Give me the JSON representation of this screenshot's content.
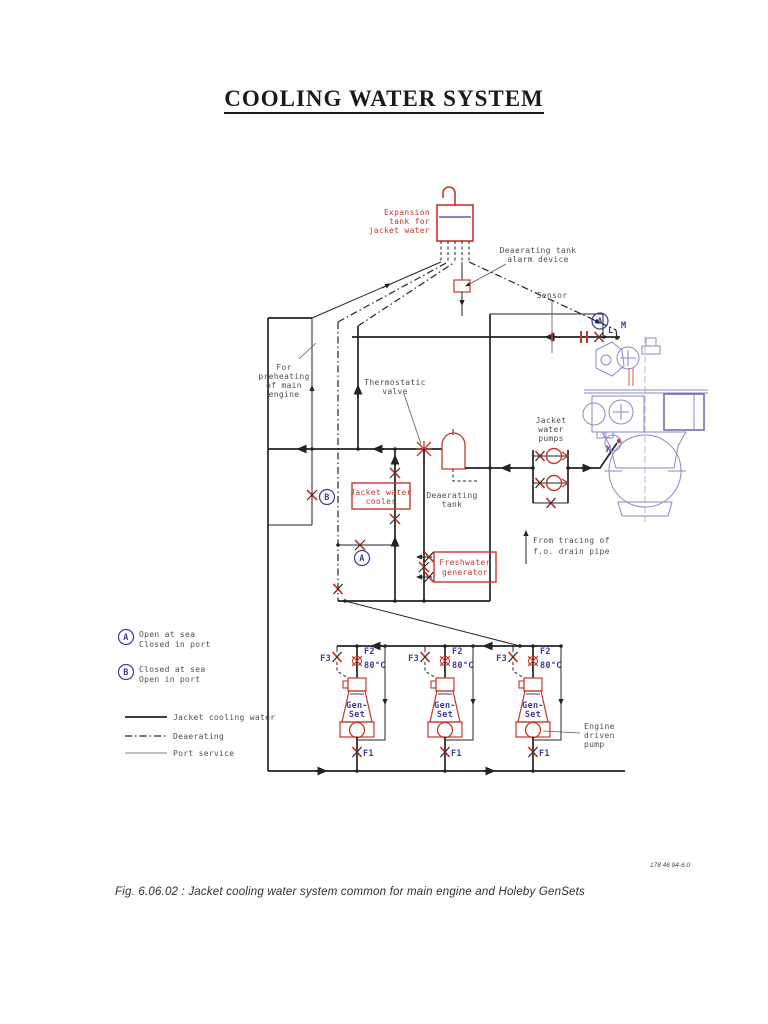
{
  "page": {
    "title": "COOLING WATER SYSTEM",
    "caption": "Fig. 6.06.02 : Jacket cooling water system common for main engine and Holeby GenSets",
    "doc_number": "178 46 94-6.0"
  },
  "colors": {
    "red": "#c4372c",
    "blue_label": "#3c3c9e",
    "engine_blue": "#8a8ac6",
    "line": "#232323"
  },
  "labels": {
    "expansion_tank": [
      "Expansion",
      "tank for",
      "jacket water"
    ],
    "deaerating_alarm": [
      "Deaerating tank",
      "alarm device"
    ],
    "sensor": "Sensor",
    "preheating": [
      "For",
      "preheating",
      "of main",
      "engine"
    ],
    "thermostatic_valve": [
      "Thermostatic",
      "valve"
    ],
    "jacket_water_cooler": [
      "Jacket water",
      "cooler"
    ],
    "deaerating_tank": [
      "Deaerating",
      "tank"
    ],
    "freshwater_generator": [
      "Freshwater",
      "generator"
    ],
    "jacket_water_pumps": [
      "Jacket",
      "water",
      "pumps"
    ],
    "fo_tracing": [
      "From tracing of",
      "f.o. drain pipe"
    ],
    "engine_driven_pump": [
      "Engine",
      "driven",
      "pump"
    ]
  },
  "connections": {
    "a": "A",
    "b": "B",
    "l": "L",
    "m": "M",
    "k": "K"
  },
  "valve_legend": {
    "a_symbol": "A",
    "a_line1": "Open at sea",
    "a_line2": "Closed in port",
    "b_symbol": "B",
    "b_line1": "Closed at sea",
    "b_line2": "Open in port"
  },
  "line_legend": [
    {
      "label": "Jacket cooling water"
    },
    {
      "label": "Deaerating"
    },
    {
      "label": "Port service"
    }
  ],
  "gensets": {
    "name_line1": "Gen-",
    "name_line2": "Set",
    "f1": "F1",
    "f2": "F2",
    "f3": "F3",
    "temp": "80°C"
  }
}
